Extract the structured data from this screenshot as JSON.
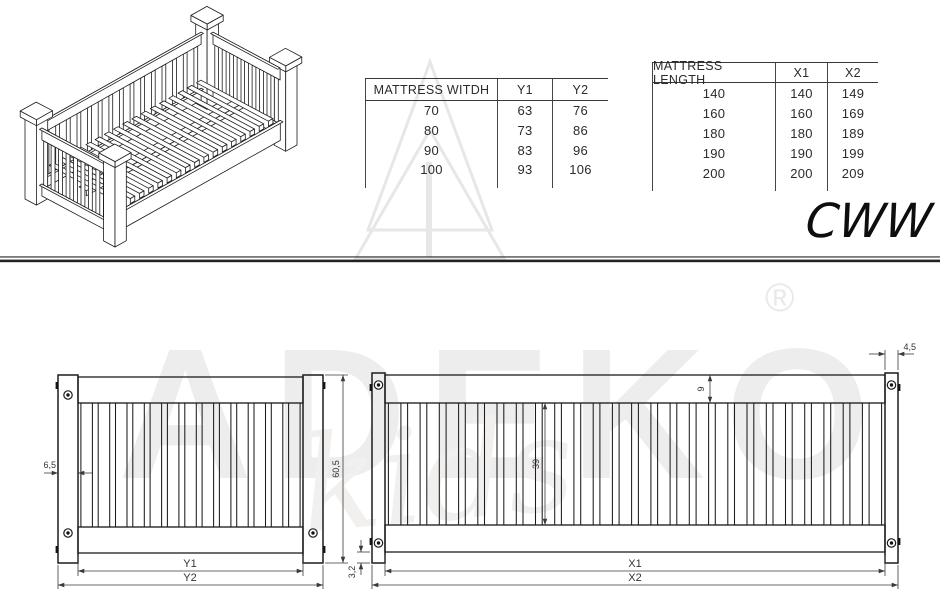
{
  "product_code": "CWW",
  "watermark": {
    "brand": "ADEKO",
    "sub": "kids",
    "registered": "®"
  },
  "tables": [
    {
      "name": "mattress_width",
      "headers": [
        "MATTRESS WITDH",
        "Y1",
        "Y2"
      ],
      "rows": [
        [
          "70",
          "63",
          "76"
        ],
        [
          "80",
          "73",
          "86"
        ],
        [
          "90",
          "83",
          "96"
        ],
        [
          "100",
          "93",
          "106"
        ]
      ]
    },
    {
      "name": "mattress_length",
      "headers": [
        "MATTRESS LENGTH",
        "X1",
        "X2"
      ],
      "rows": [
        [
          "140",
          "140",
          "149"
        ],
        [
          "160",
          "160",
          "169"
        ],
        [
          "180",
          "180",
          "189"
        ],
        [
          "190",
          "190",
          "199"
        ],
        [
          "200",
          "200",
          "209"
        ]
      ]
    }
  ],
  "dimensions": {
    "panel_y": {
      "post_width": "6,5",
      "total_height": "60,5",
      "inner_width": "Y1",
      "outer_width": "Y2"
    },
    "panel_x": {
      "post_width": "4,5",
      "rail_height": "9",
      "slat_height": "39",
      "bottom_overhang": "3,2",
      "inner_width": "X1",
      "outer_width": "X2"
    }
  },
  "drawings": {
    "iso_view": {
      "back_slats": 15,
      "right_slats": 9,
      "left_slats": 9,
      "base_slats": 17
    },
    "panel_y_slats": 13,
    "panel_x_slats": 26
  },
  "colors": {
    "line": "#1c1c1c",
    "dim_line": "#3a3a3a",
    "watermark": "#ededed"
  }
}
